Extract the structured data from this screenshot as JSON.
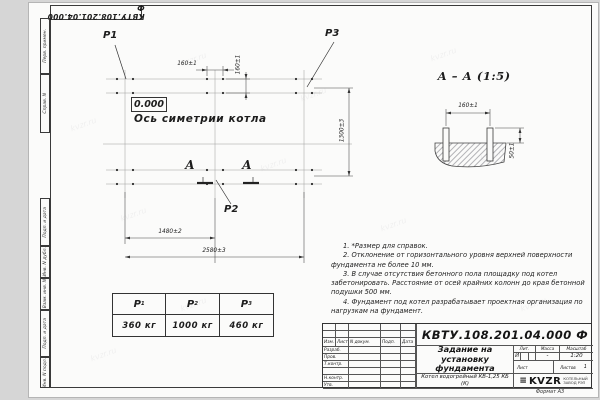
{
  "watermark": "kvzr.ru",
  "icons": {
    "logo_bars": "≡"
  },
  "frame": {
    "stamp": "КВТУ.108.201.04.000 Ф",
    "format": "Формат А3",
    "side_labels": [
      "Перв. примен.",
      "Справ. N",
      "Подп. и дата",
      "Инв. N дубл.",
      "Взам. инв. N",
      "Подп. и дата",
      "Инв. N подл."
    ]
  },
  "plan": {
    "point_labels": {
      "p1": "P1",
      "p2": "P2",
      "p3": "P3"
    },
    "elevation": "0.000",
    "axis_label": "Ось симетрии котла",
    "section_letter": "А",
    "dims": {
      "bolt_spacing_h": "160±1",
      "bolt_spacing_v": "160±1",
      "height": "1300±3",
      "mid_span": "1480±2",
      "total_span": "2580±3"
    }
  },
  "section_view": {
    "title": "А – А (1:5)",
    "dims": {
      "bolt_spacing": "160±1",
      "bolt_height": "50±1"
    }
  },
  "notes": [
    "1. *Размер для справок.",
    "2. Отклонение от горизонтального уровня верхней поверхности фундамента не более 10 мм.",
    "3. В случае отсутствия бетонного пола площадку под котел забетонировать. Расстояние от осей крайних колонн до края бетонной подушки 500 мм.",
    "4. Фундамент под котел разрабатывает проектная организация по нагрузкам на фундамент."
  ],
  "load_table": {
    "columns": [
      {
        "label": "P",
        "sub": "1",
        "value": "360 кг"
      },
      {
        "label": "P",
        "sub": "2",
        "value": "1000 кг"
      },
      {
        "label": "P",
        "sub": "3",
        "value": "460 кг"
      }
    ]
  },
  "title_block": {
    "doc_number": "КВТУ.108.201.04.000 Ф",
    "doc_title": "Задание на установку фундамента",
    "product": "Котел водогрейный КВ-1,25 КБ (К)",
    "rev_cols": [
      "Изм.",
      "Лист",
      "N докум.",
      "Подп.",
      "Дата"
    ],
    "roles": [
      "Разраб.",
      "Пров.",
      "Т.контр.",
      "Н.контр.",
      "Утв."
    ],
    "props": {
      "lit_h": "Лит.",
      "mass_h": "Масса",
      "scale_h": "Масштаб",
      "lit": "И",
      "mass": "-",
      "scale": "1:20",
      "sheet_h": "Лист",
      "sheets_h": "Листов",
      "sheets_total": "1"
    },
    "company": {
      "logo": "KVZR",
      "line1": "КОТЕЛЬНЫЙ",
      "line2": "ЗАВОД РЭП"
    }
  }
}
